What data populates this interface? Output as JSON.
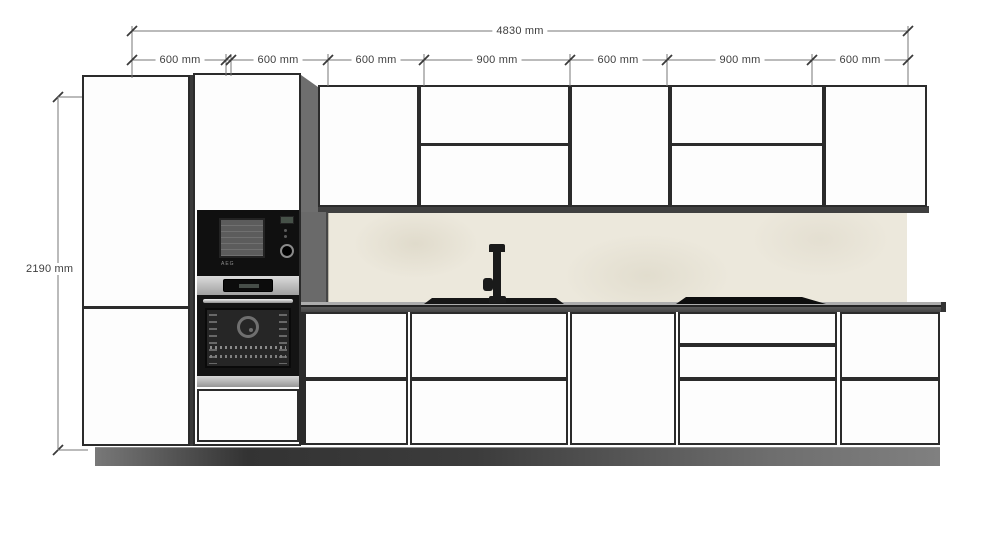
{
  "drawing": {
    "title": "kitchen-elevation",
    "dimensions": {
      "total_width": "4830 mm",
      "height": "2190 mm",
      "segments": [
        {
          "label": "600 mm"
        },
        {
          "label": "600 mm"
        },
        {
          "label": "600 mm"
        },
        {
          "label": "900 mm"
        },
        {
          "label": "600 mm"
        },
        {
          "label": "900 mm"
        },
        {
          "label": "600 mm"
        }
      ]
    },
    "appliances": {
      "microwave_brand": "AEG"
    },
    "colors": {
      "outline": "#2b2b2b",
      "dimension_line": "#777777",
      "dimension_text": "#3f3f3f",
      "cabinet_fill": "#fdfdfd",
      "backsplash": "#ece8dc",
      "side_panel": "#6e6e6e",
      "countertop_face": "#5a5a5a",
      "plinth_dark": "#333333",
      "plinth_light": "#7d7d7d",
      "appliance_black": "#121212",
      "stainless": "#c8c8c8"
    }
  }
}
